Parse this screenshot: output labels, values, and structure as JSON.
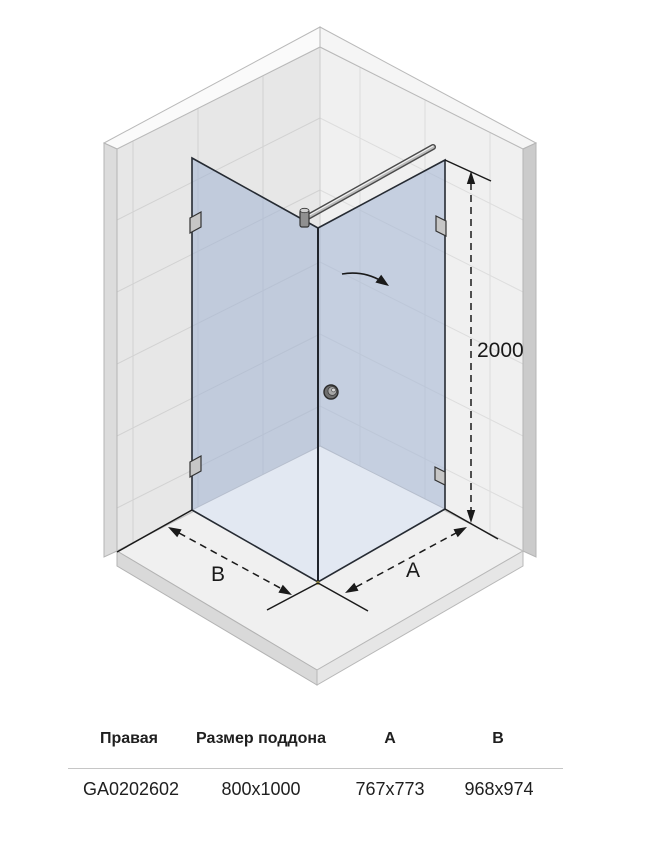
{
  "diagram": {
    "height_label": "2000",
    "side_b_label": "B",
    "side_a_label": "A",
    "colors": {
      "glass": "#a3b4d4",
      "glass_floor": "#e2e8f2",
      "wall_left": "#e7e7e7",
      "wall_right": "#f0f0f0",
      "floor": "#f0f0f0",
      "line": "#1a1a1a"
    }
  },
  "table": {
    "headers": [
      "Правая",
      "Размер поддона",
      "A",
      "B"
    ],
    "row": [
      "GA0202602",
      "800x1000",
      "767x773",
      "968x974"
    ]
  }
}
